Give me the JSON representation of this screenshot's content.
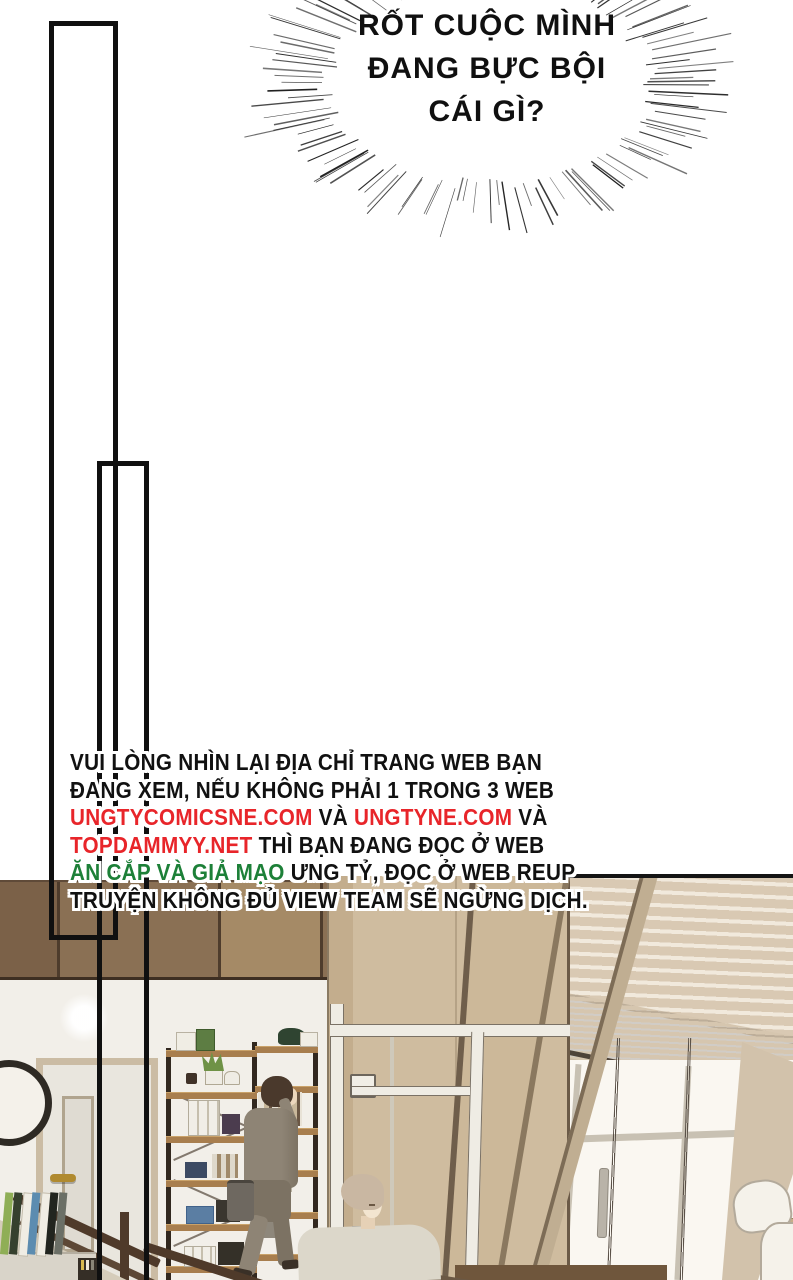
{
  "page": {
    "kind": "comic-page",
    "width": 793,
    "height": 1280,
    "background": "#ffffff"
  },
  "speech_bubble": {
    "lines": [
      "RỐT CUỘC MÌNH",
      "ĐANG BỰC BỘI",
      "CÁI GÌ?"
    ],
    "text_color": "#101010"
  },
  "notice": {
    "colors": {
      "black": "#111111",
      "red": "#e8252a",
      "green": "#1d8038",
      "outline": "#ffffff"
    },
    "lines": [
      {
        "segments": [
          {
            "text": "VUI LÒNG NHÌN LẠI ĐỊA CHỈ TRANG WEB BẠN",
            "color": "black"
          }
        ]
      },
      {
        "segments": [
          {
            "text": "ĐANG XEM, NẾU KHÔNG PHẢI 1 TRONG 3 WEB",
            "color": "black"
          }
        ]
      },
      {
        "segments": [
          {
            "text": "UNGTYCOMICSNE.COM",
            "color": "red"
          },
          {
            "text": " VÀ ",
            "color": "black"
          },
          {
            "text": "UNGTYNE.COM",
            "color": "red"
          },
          {
            "text": " VÀ",
            "color": "black"
          }
        ]
      },
      {
        "segments": [
          {
            "text": "TOPDAMMYY.NET",
            "color": "red"
          },
          {
            "text": " THÌ BẠN ĐANG ĐỌC Ở WEB",
            "color": "black"
          }
        ]
      },
      {
        "segments": [
          {
            "text": "ĂN CẮP VÀ GIẢ MẠO",
            "color": "green"
          },
          {
            "text": " ƯNG TỶ, ĐỌC Ở WEB REUP",
            "color": "black"
          }
        ]
      },
      {
        "segments": [
          {
            "text": "TRUYỆN KHÔNG ĐỦ VIEW TEAM SẼ NGỪNG DỊCH.",
            "color": "black"
          }
        ]
      }
    ]
  },
  "scene": {
    "palette": {
      "wall": "#f2efe9",
      "band1": "#7b6148",
      "band2": "#8a7054",
      "band3": "#a58a66",
      "bandSeam": "#4e3c2c",
      "wood": "#cfbc9f",
      "woodCol": "#c3ad8d",
      "woodDark": "#6b5a47",
      "stair": "#ccb899",
      "stair2": "#c0ae92",
      "blindSlat": "#d9c9b3",
      "blindGap": "#f1e9dc",
      "blindStack": "#d6c6af",
      "valance": "#c9b9a2",
      "glass": "#faf7f1",
      "mullion": "#c8c1b3",
      "frameWhite": "#efece4",
      "curtain": "#d2c2ab",
      "suit": "#8e8475",
      "suitDark": "#7c7263",
      "hairDark": "#4a392c",
      "skin": "#ecd7bd",
      "bag": "#6e6860",
      "shirt": "#dcd7ca",
      "hairLight": "#c9b7a2",
      "skin2": "#f3e5d0",
      "shelfFrame": "#32281f",
      "shelfWood": "#a87e4e",
      "door": "#e9e6de",
      "doorFrame": "#cbbca4",
      "handleGold": "#b08a2f",
      "rail": "#4f3a2a",
      "cabinet": "#d9d4c9",
      "chair": "#f5f2ea",
      "chairLine": "#b3aa9b",
      "plant": "#6f9246",
      "ink": "#141414"
    }
  }
}
